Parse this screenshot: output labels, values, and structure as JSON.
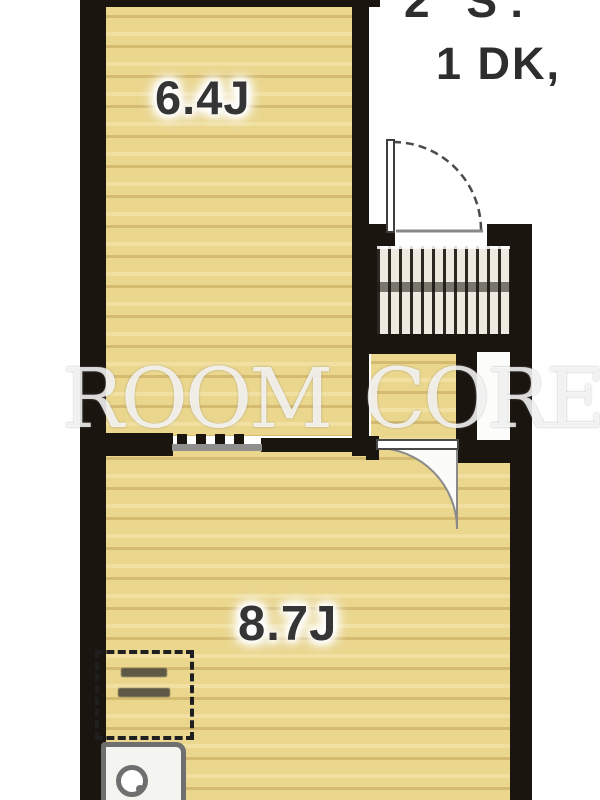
{
  "header": {
    "clipped_top_line": "2 S:",
    "plan_type": "1 DK,"
  },
  "watermark": {
    "text": "ROOM CORE"
  },
  "rooms": [
    {
      "name": "western-room",
      "size_label": "6.4J"
    },
    {
      "name": "dining-kitchen",
      "size_label": "8.7J"
    }
  ],
  "fixtures": {
    "entrance_door": "hinged-door-swing",
    "room_door": "hinged-door-swing",
    "entrance_stairs": "staircase-hatch",
    "closet": "white-storage-box",
    "partition": "sliding-partition-with-teeth",
    "refrigerator_space": "dashed-outline-box",
    "kitchen_sink": "sink-counter-with-burner"
  },
  "colors": {
    "wall": "#1b1510",
    "floor": "#ead68c",
    "floor_stripe": "#ba9a4e",
    "label_text": "#353535",
    "watermark": "#ffffff",
    "background": "#ffffff"
  }
}
